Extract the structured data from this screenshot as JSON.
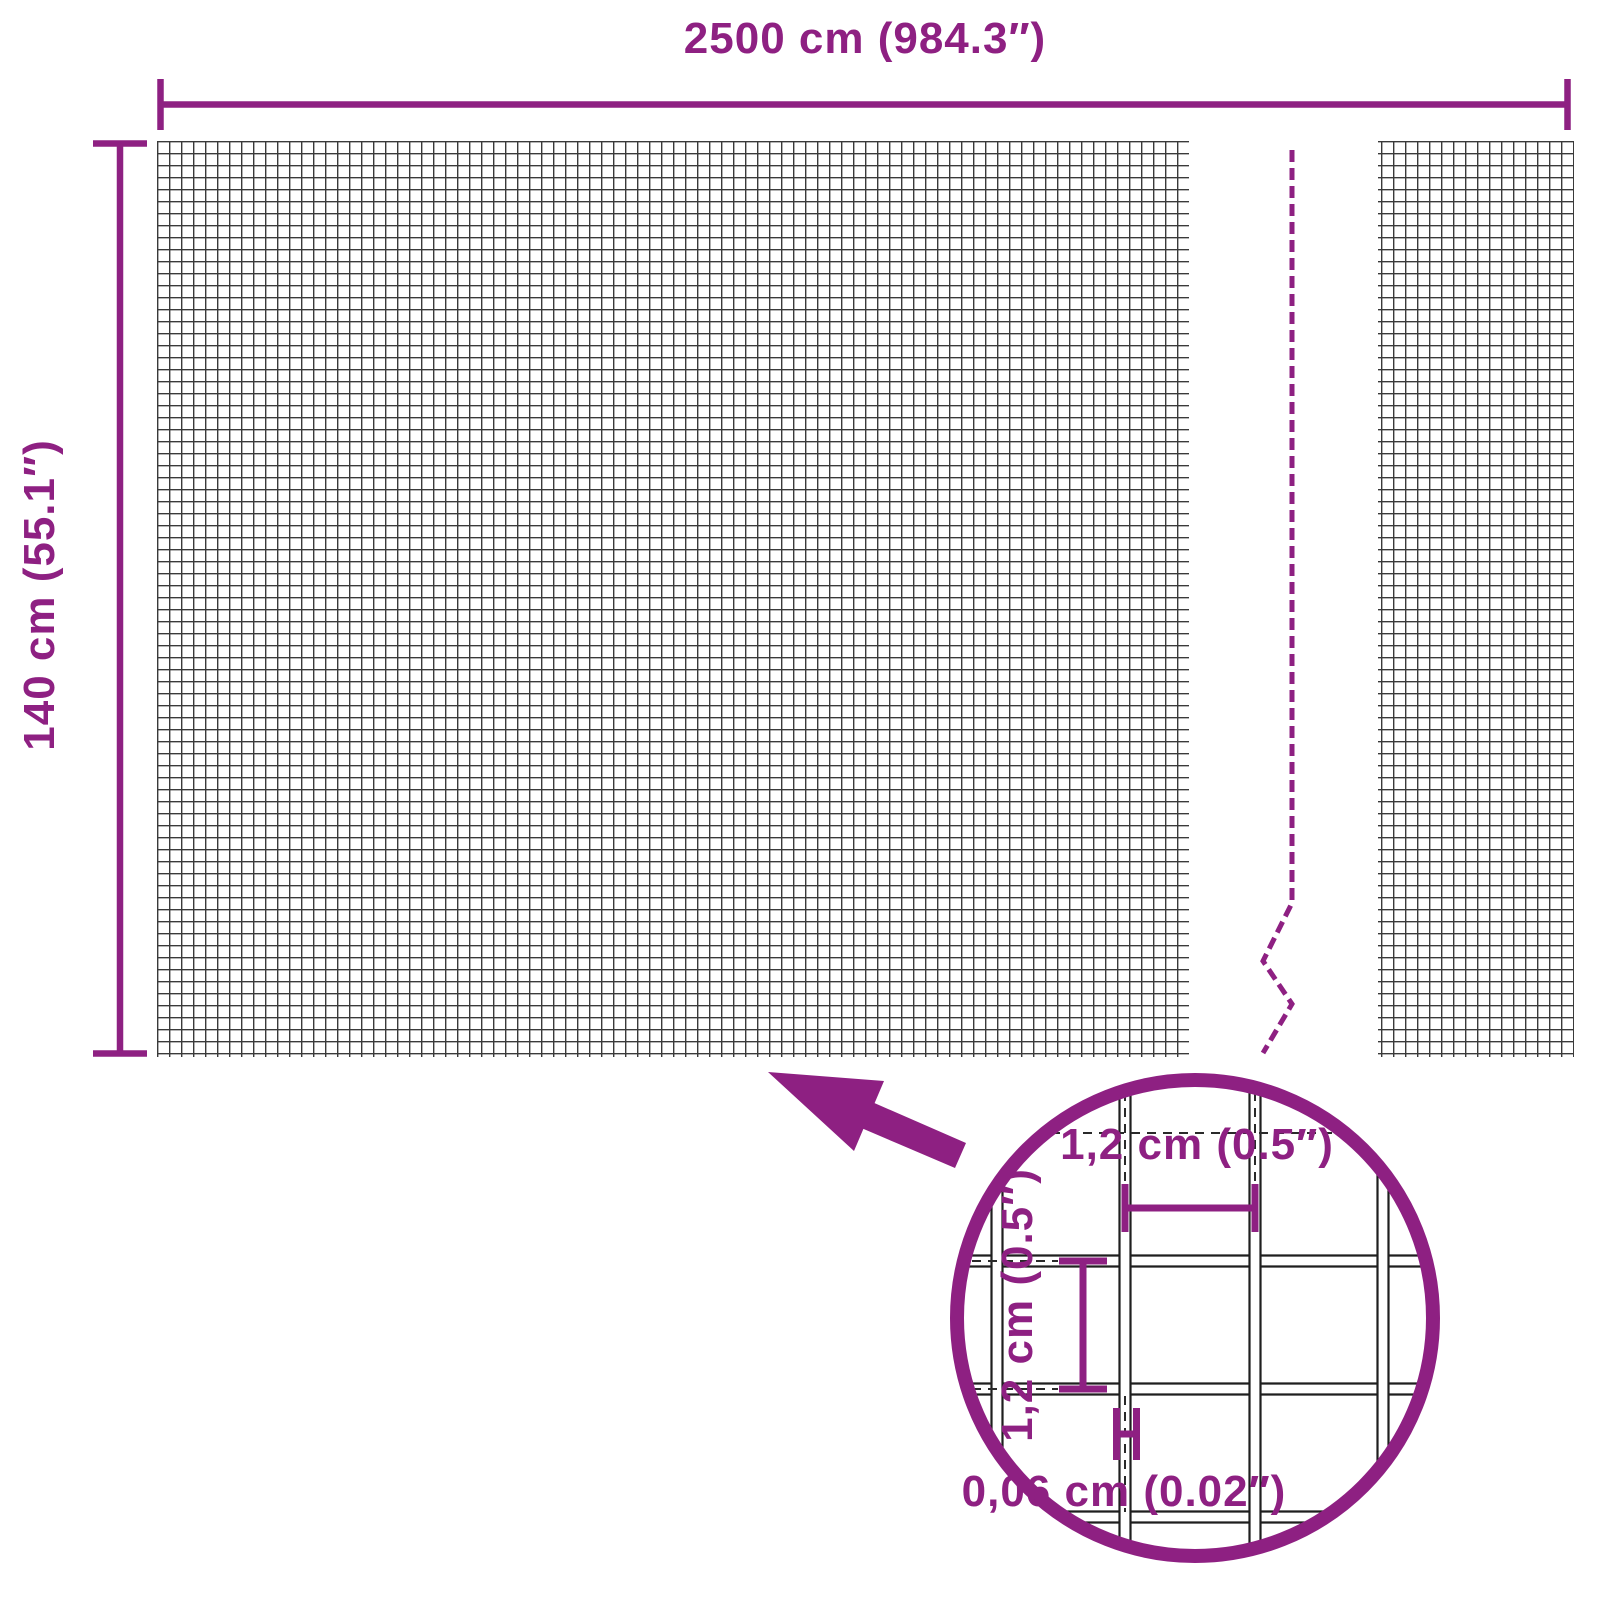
{
  "diagram": {
    "type": "product-dimensions-diagram",
    "product": "wire mesh panel",
    "labels": {
      "total_width": "2500 cm (984.3″)",
      "total_height": "140 cm (55.1″)",
      "mesh_opening_width": "1,2 cm (0.5″)",
      "mesh_opening_height": "1,2 cm (0.5″)",
      "wire_thickness": "0,06 cm (0.02″)"
    },
    "colors": {
      "accent_purple": "#8e2082",
      "mesh_line": "#3a3a3a",
      "lens_mesh_line": "#1f1f1f",
      "background": "#ffffff"
    },
    "icons": {
      "lens": "magnifier-circle-icon",
      "pointer": "arrow-up-left-icon",
      "break": "dashed-break-line"
    }
  }
}
